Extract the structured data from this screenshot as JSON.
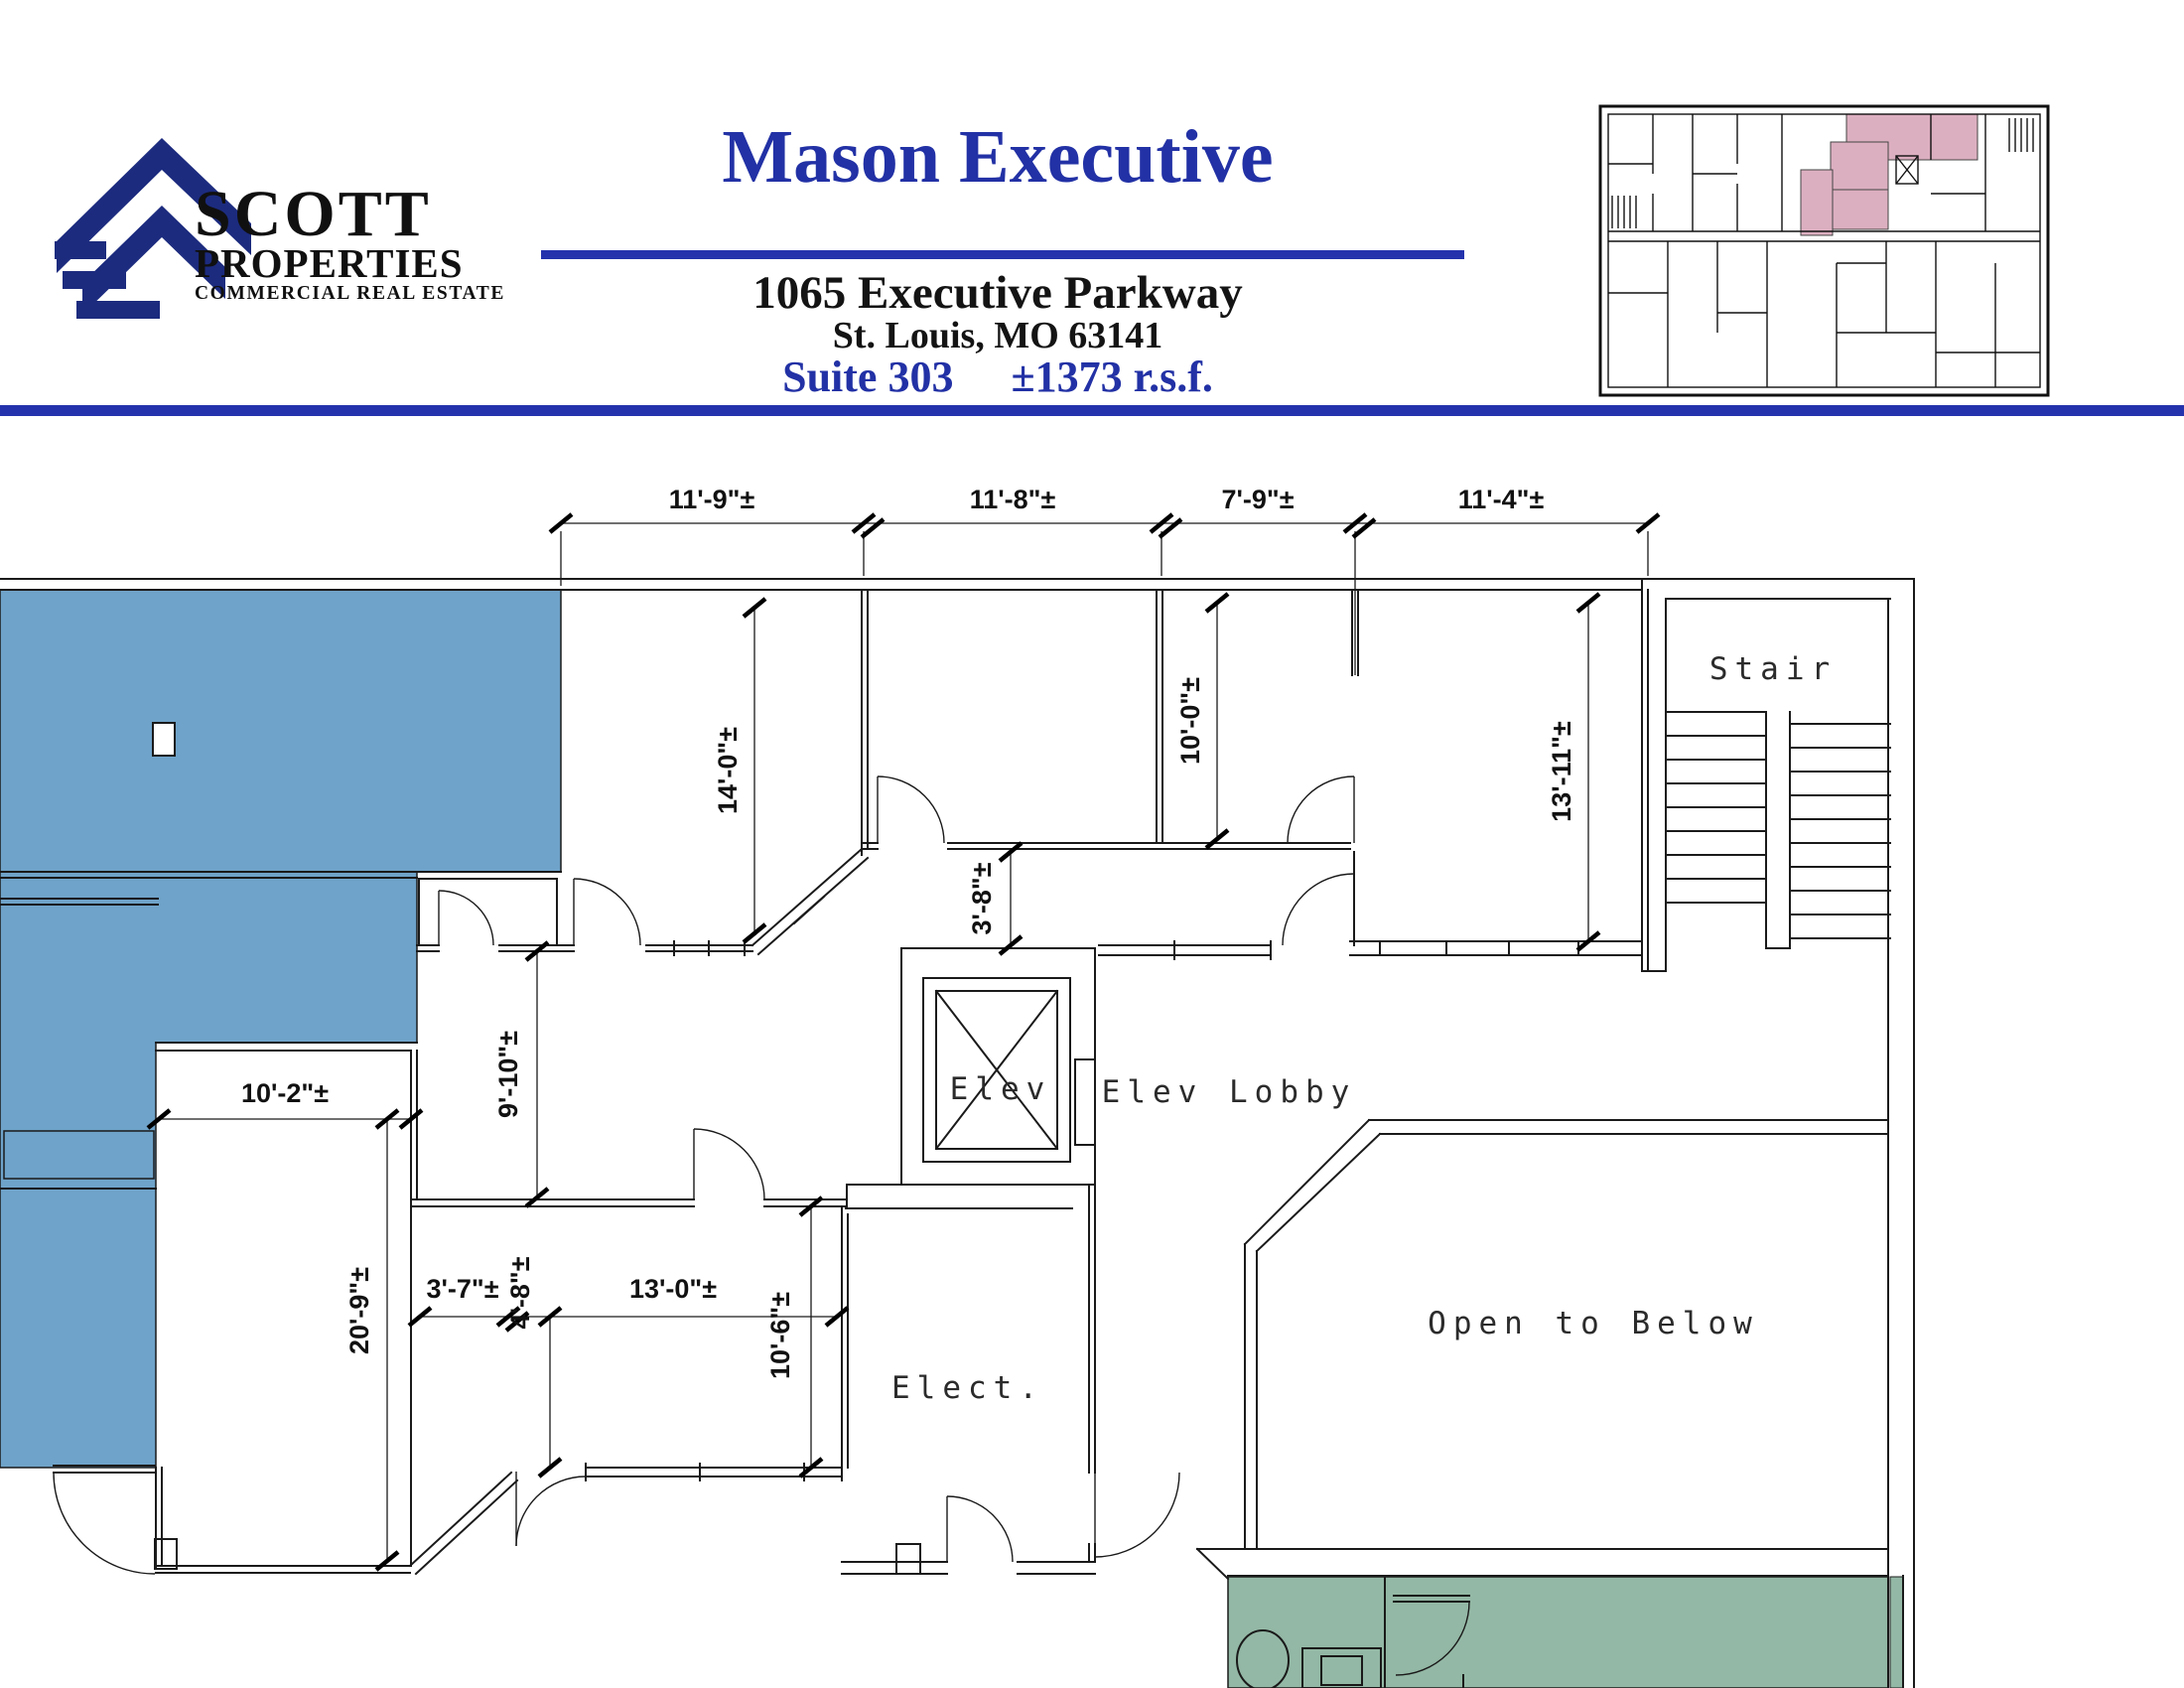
{
  "header": {
    "logo": {
      "name": "SCOTT",
      "sub": "PROPERTIES",
      "tagline": "COMMERCIAL REAL ESTATE"
    },
    "building_title": "Mason Executive",
    "address_line1": "1065 Executive Parkway",
    "address_line2": "St. Louis, MO  63141",
    "suite_label": "Suite 303",
    "area_label": "±1373 r.s.f."
  },
  "colors": {
    "suite_blue": "#6FA3C9",
    "suite_green": "#93B8A5",
    "keyplan_pink": "#DCAFC0",
    "brand_blue": "#2433AC",
    "logo_navy": "#1C2B7E"
  },
  "floor_plan": {
    "room_labels": {
      "stair": "Stair",
      "elev": "Elev",
      "elev_lobby": "Elev Lobby",
      "open_to_below": "Open to Below",
      "elect": "Elect."
    },
    "dims": {
      "top1": "11'-9\"±",
      "top2": "11'-8\"±",
      "top3": "7'-9\"±",
      "top4": "11'-4\"±",
      "d14_0": "14'-0\"±",
      "d10_0": "10'-0\"±",
      "d13_11": "13'-11\"±",
      "d3_8": "3'-8\"±",
      "d9_10": "9'-10\"±",
      "d10_2": "10'-2\"±",
      "d20_9": "20'-9\"±",
      "d3_7": "3'-7\"±",
      "d13_0": "13'-0\"±",
      "d10_6": "10'-6\"±",
      "d4_8": "4'-8\"±"
    }
  }
}
